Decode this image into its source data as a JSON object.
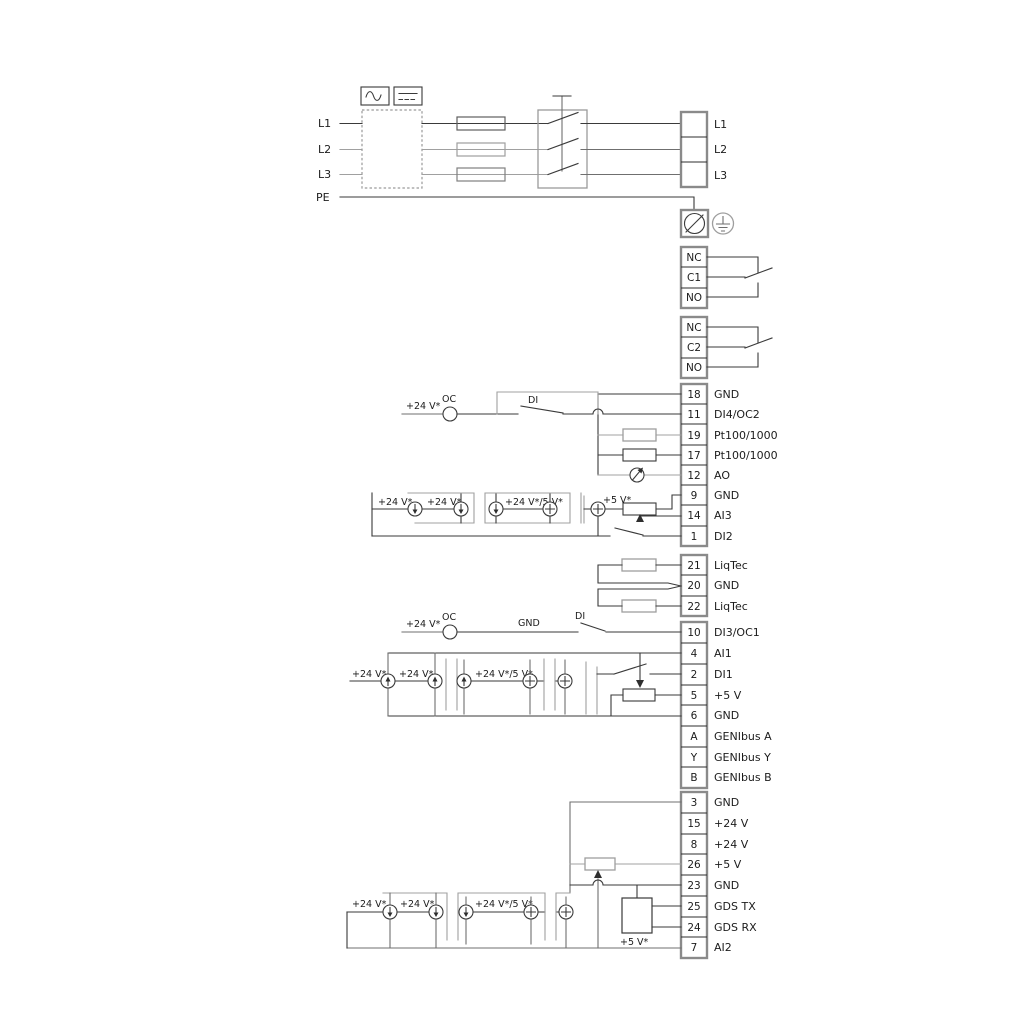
{
  "power": {
    "input_labels": [
      "L1",
      "L2",
      "L3",
      "PE"
    ],
    "output_labels": [
      "L1",
      "L2",
      "L3"
    ]
  },
  "blocks": {
    "relay1": [
      "NC",
      "C1",
      "NO"
    ],
    "relay2": [
      "NC",
      "C2",
      "NO"
    ],
    "io1": [
      {
        "n": "18",
        "label": "GND"
      },
      {
        "n": "11",
        "label": "DI4/OC2"
      },
      {
        "n": "19",
        "label": "Pt100/1000"
      },
      {
        "n": "17",
        "label": "Pt100/1000"
      },
      {
        "n": "12",
        "label": "AO"
      },
      {
        "n": "9",
        "label": "GND"
      },
      {
        "n": "14",
        "label": "AI3"
      },
      {
        "n": "1",
        "label": "DI2"
      }
    ],
    "liqtec": [
      {
        "n": "21",
        "label": "LiqTec"
      },
      {
        "n": "20",
        "label": "GND"
      },
      {
        "n": "22",
        "label": "LiqTec"
      }
    ],
    "io2": [
      {
        "n": "10",
        "label": "DI3/OC1"
      },
      {
        "n": "4",
        "label": "AI1"
      },
      {
        "n": "2",
        "label": "DI1"
      },
      {
        "n": "5",
        "label": "+5 V"
      },
      {
        "n": "6",
        "label": "GND"
      },
      {
        "n": "A",
        "label": "GENIbus A"
      },
      {
        "n": "Y",
        "label": "GENIbus Y"
      },
      {
        "n": "B",
        "label": "GENIbus B"
      }
    ],
    "io3": [
      {
        "n": "3",
        "label": "GND"
      },
      {
        "n": "15",
        "label": "+24 V"
      },
      {
        "n": "8",
        "label": "+24 V"
      },
      {
        "n": "26",
        "label": "+5 V"
      },
      {
        "n": "23",
        "label": "GND"
      },
      {
        "n": "25",
        "label": "GDS TX"
      },
      {
        "n": "24",
        "label": "GDS RX"
      },
      {
        "n": "7",
        "label": "AI2"
      }
    ]
  },
  "ann": {
    "v24": "+24 V*",
    "oc": "OC",
    "di": "DI",
    "gnd": "GND",
    "v24_5": "+24 V*/5 V*",
    "v5": "+5 V*"
  },
  "colors": {
    "wire_dark": "#3a3a3a",
    "wire_gray": "#a0a0a0",
    "block_border": "#8a8a8a"
  }
}
